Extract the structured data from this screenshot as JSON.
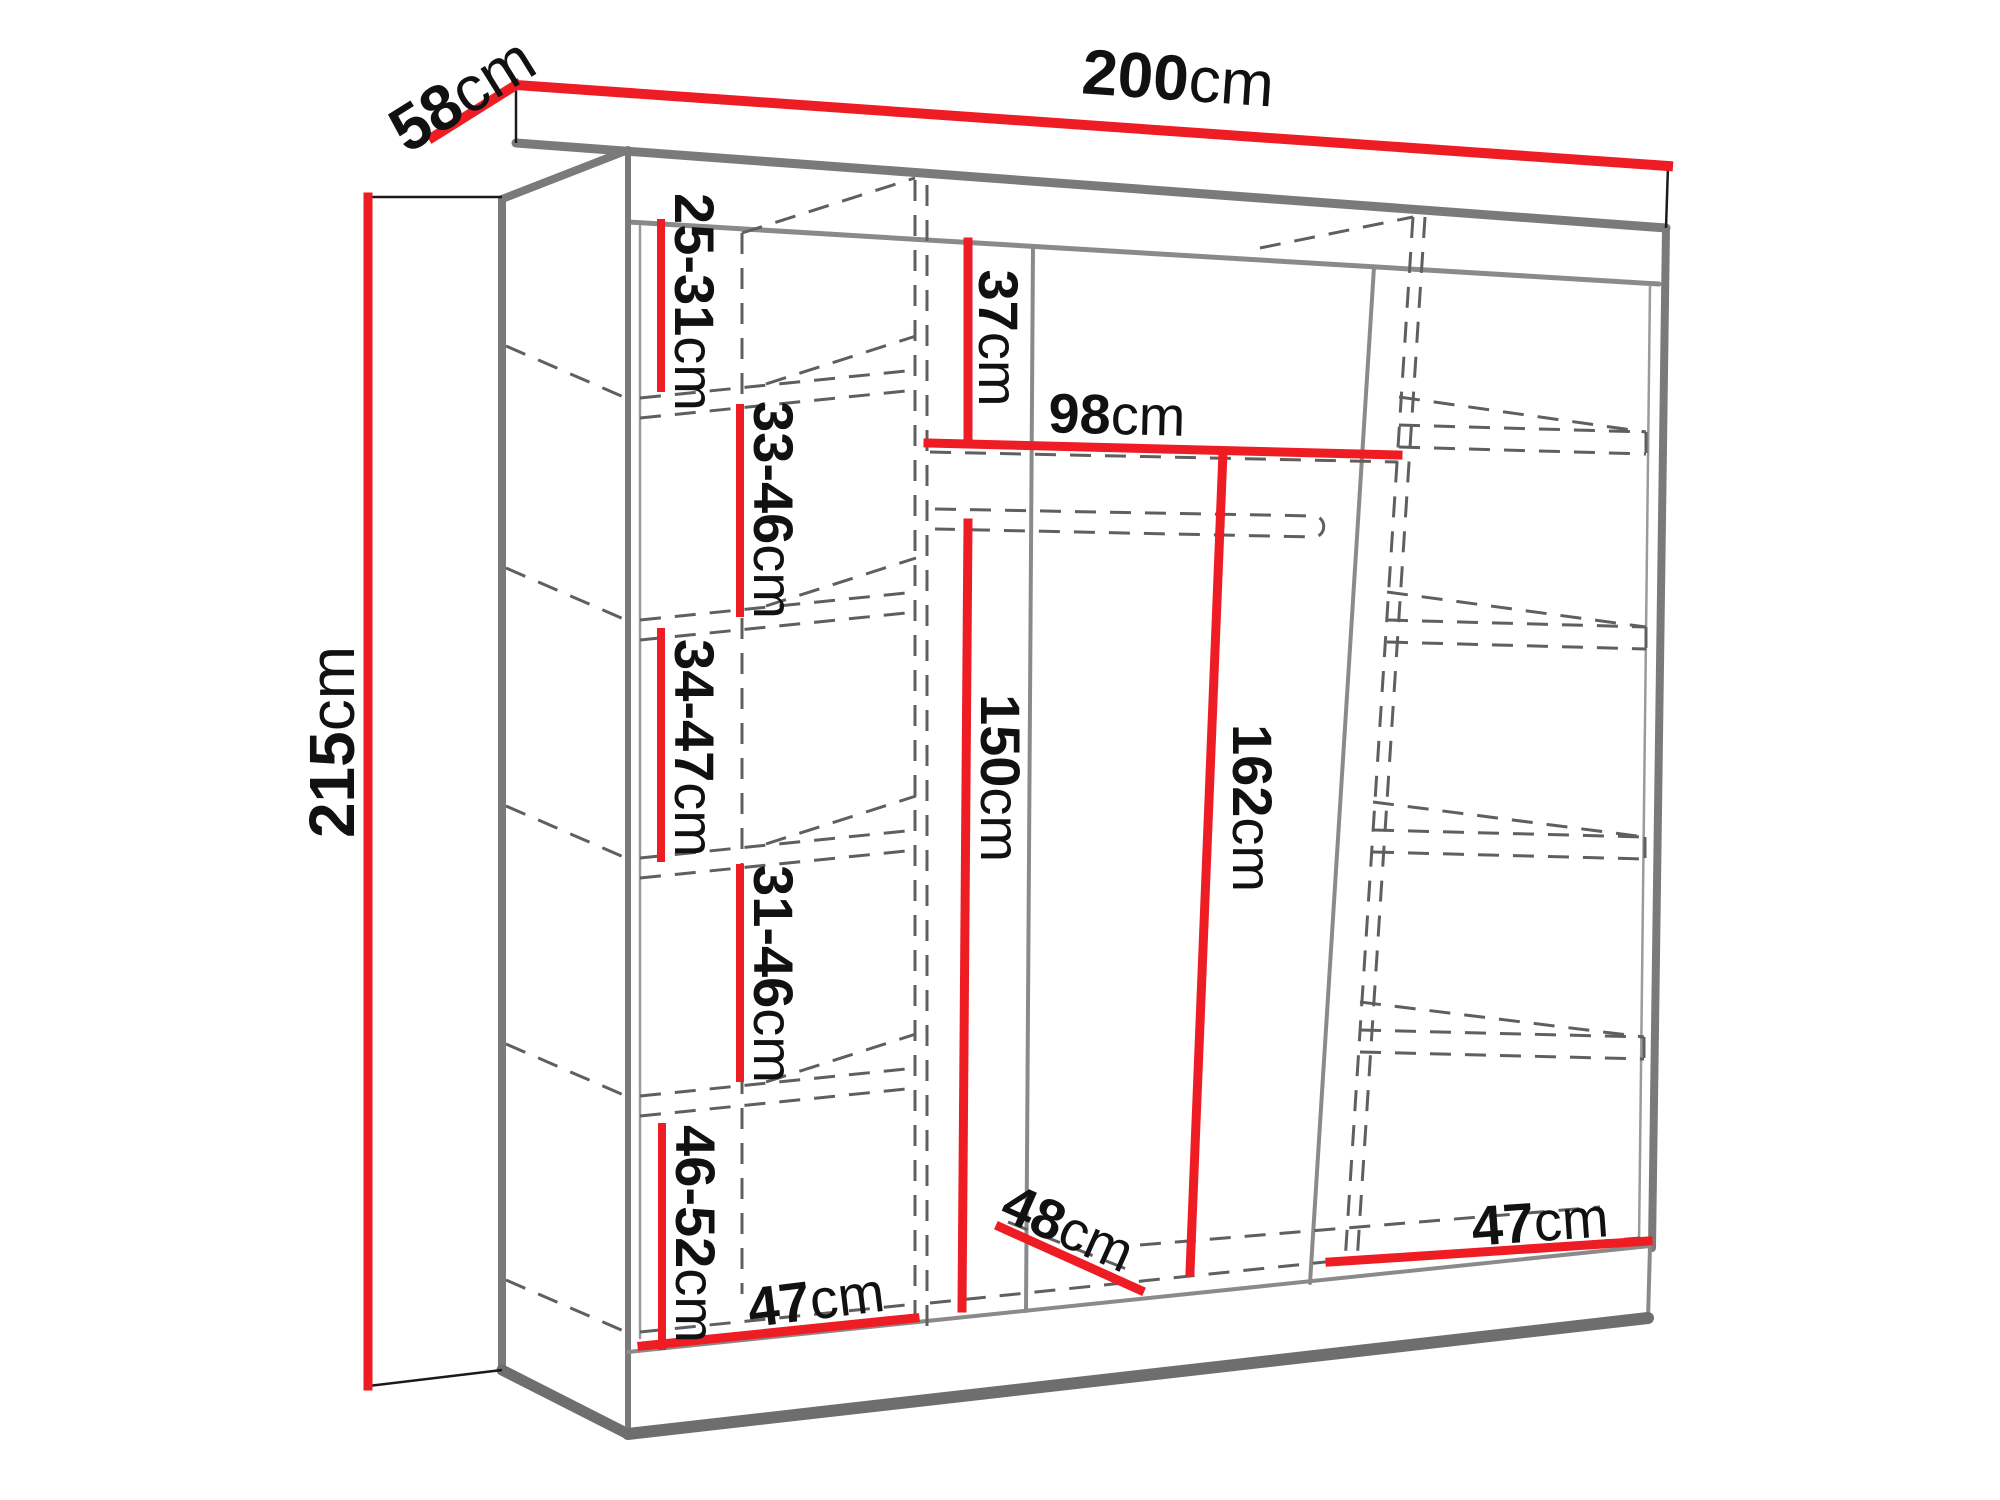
{
  "diagram": {
    "type": "wardrobe-dimension-drawing",
    "background": "#ffffff",
    "accent_color": "#ee1c23",
    "edge_color": "#7a7a7a",
    "hidden_line_color": "#5f5f5f",
    "text_color": "#111111",
    "unit": "cm"
  },
  "dimensions": {
    "width": {
      "value": "200",
      "unit": "cm"
    },
    "depth": {
      "value": "58",
      "unit": "cm"
    },
    "height": {
      "value": "215",
      "unit": "cm"
    },
    "left_gap_1": {
      "value": "25-31",
      "unit": "cm"
    },
    "left_gap_2": {
      "value": "33-46",
      "unit": "cm"
    },
    "left_gap_3": {
      "value": "34-47",
      "unit": "cm"
    },
    "left_gap_4": {
      "value": "31-46",
      "unit": "cm"
    },
    "left_gap_5": {
      "value": "46-52",
      "unit": "cm"
    },
    "top_clearance": {
      "value": "37",
      "unit": "cm"
    },
    "middle_width": {
      "value": "98",
      "unit": "cm"
    },
    "hanging_height": {
      "value": "150",
      "unit": "cm"
    },
    "right_height": {
      "value": "162",
      "unit": "cm"
    },
    "interior_depth": {
      "value": "48",
      "unit": "cm"
    },
    "left_shelf_width": {
      "value": "47",
      "unit": "cm"
    },
    "right_shelf_width": {
      "value": "47",
      "unit": "cm"
    }
  }
}
